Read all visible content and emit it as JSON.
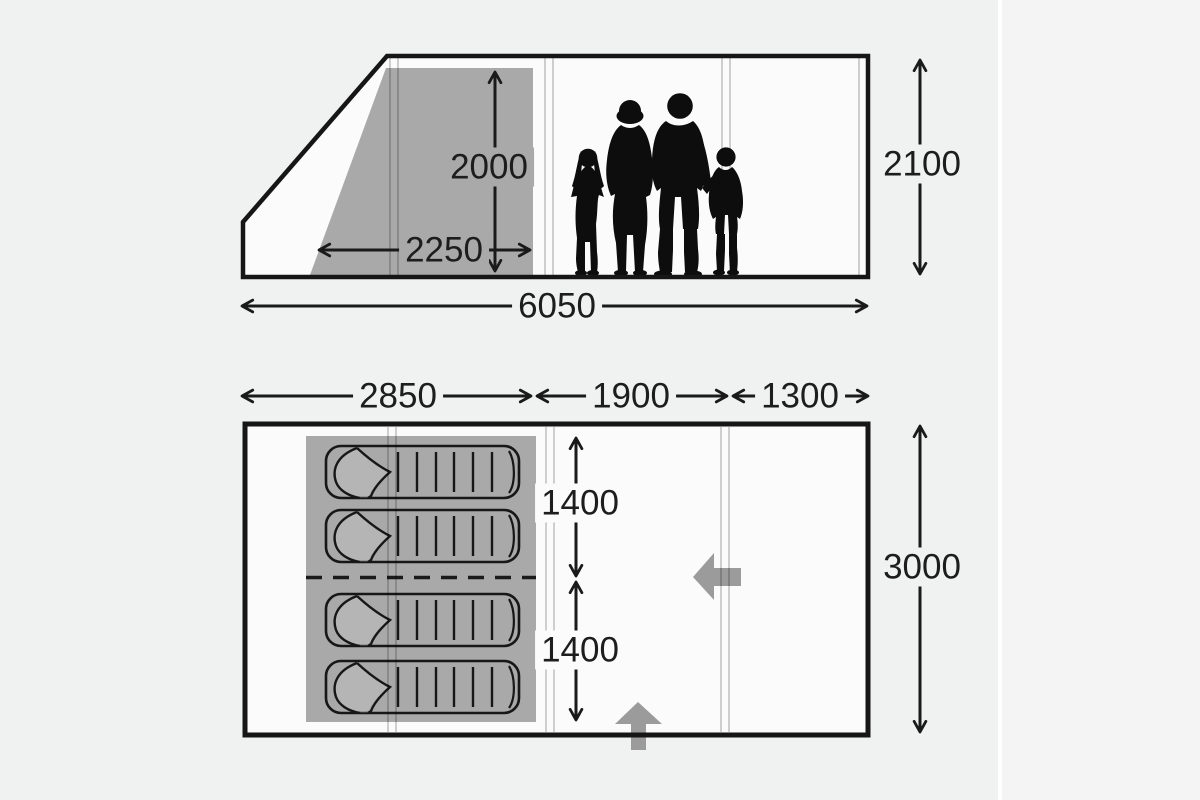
{
  "meta": {
    "description": "Tent dimensions diagram: side profile with family silhouette (top) and floor plan with four sleeping bags (bottom). Measurements in millimetres."
  },
  "side_view": {
    "bedroom_inner_height": "2000",
    "bedroom_depth": "2250",
    "max_height": "2100",
    "total_length": "6050"
  },
  "floor_plan": {
    "bedroom_length": "2850",
    "living_area_length": "1900",
    "front_canopy_length": "1300",
    "total_width": "3000",
    "berth_width_top": "1400",
    "berth_width_bottom": "1400"
  },
  "icons": {
    "family_silhouette": "family of four standing silhouette",
    "sleeping_bag": "sleeping bag with folded-open top",
    "door_arrow_side": "left-pointing side entrance arrow",
    "door_arrow_front": "up-pointing front entrance arrow"
  },
  "colors": {
    "background": "#f0f1f1",
    "tent_interior": "#fbfbfc",
    "shaded_sleeping_area": "#a9a9a9",
    "outline": "#161616",
    "entrance_arrow": "#9b9b9b",
    "label_text": "#1d1d1d"
  }
}
